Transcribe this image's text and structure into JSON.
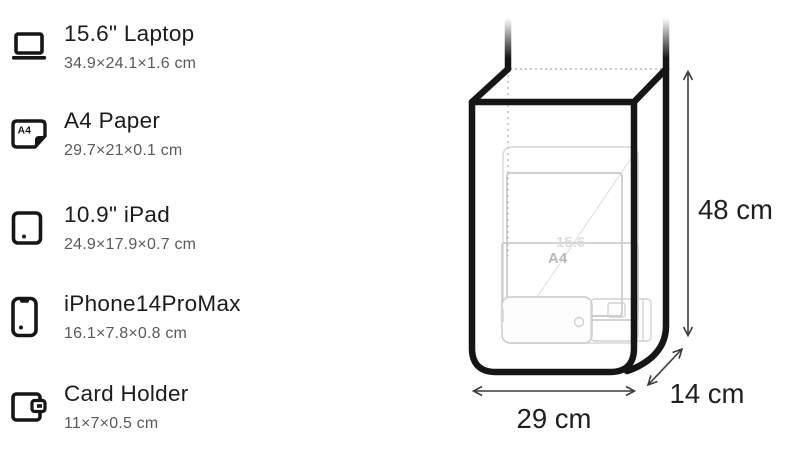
{
  "items": [
    {
      "title": "15.6\" Laptop",
      "dims": "34.9×24.1×1.6 cm",
      "icon": "laptop"
    },
    {
      "title": "A4 Paper",
      "dims": "29.7×21×0.1 cm",
      "icon": "a4-paper",
      "icon_label": "A4"
    },
    {
      "title": "10.9\" iPad",
      "dims": "24.9×17.9×0.7 cm",
      "icon": "ipad"
    },
    {
      "title": "iPhone14ProMax",
      "dims": "16.1×7.8×0.8 cm",
      "icon": "iphone"
    },
    {
      "title": "Card Holder",
      "dims": "11×7×0.5 cm",
      "icon": "card-holder"
    }
  ],
  "diagram": {
    "height_label": "48 cm",
    "width_label": "29 cm",
    "depth_label": "14 cm",
    "inner_labels": {
      "laptop": "15.6",
      "a4": "A4"
    },
    "colors": {
      "bag_outline": "#161616",
      "icon": "#161616",
      "title_text": "#1c1c1c",
      "dims_text": "#5a5a5a",
      "dimension_text": "#1f1f1f",
      "faint_item_outline": "#c9c9c9",
      "dotted_guide": "#bdbdbd"
    }
  }
}
